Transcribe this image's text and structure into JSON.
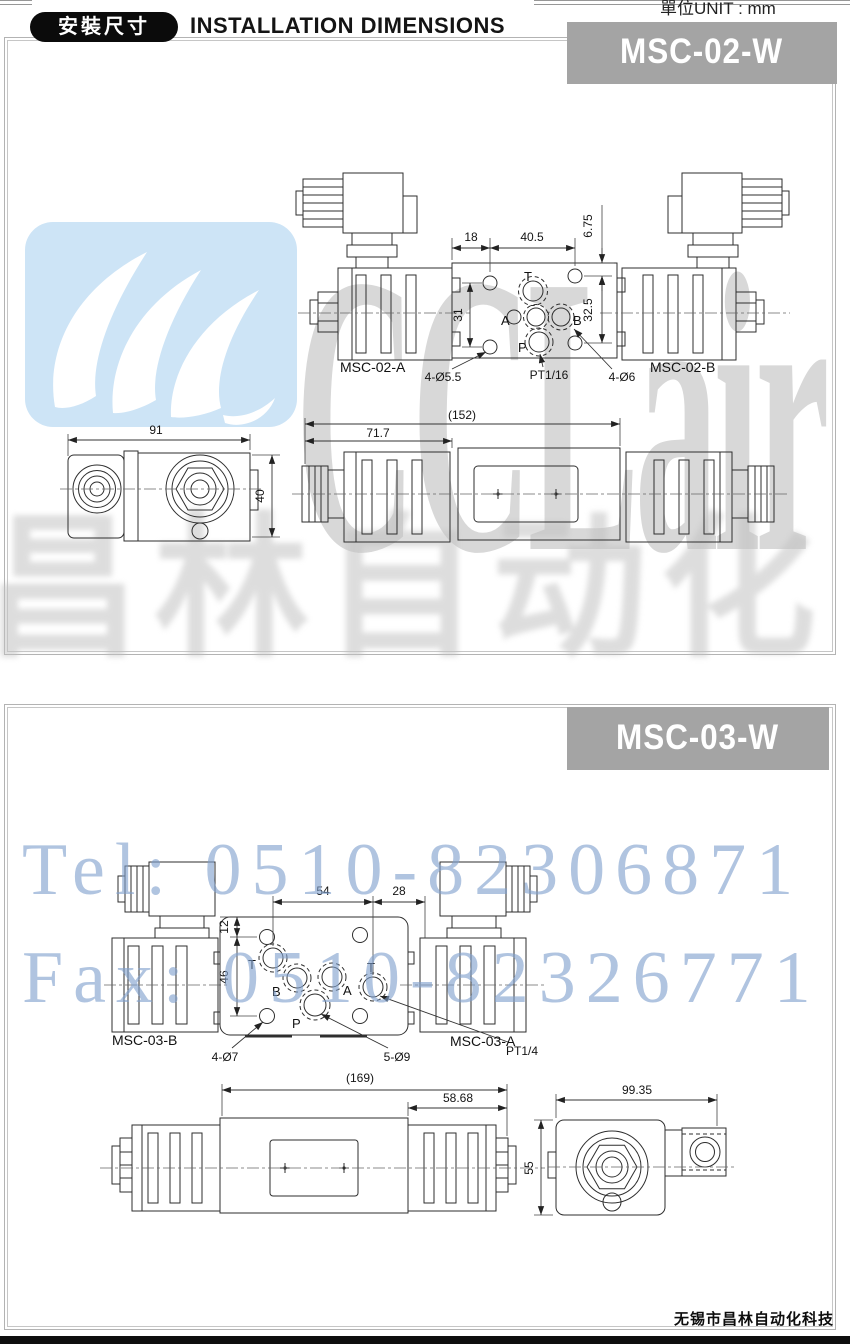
{
  "header": {
    "badge": "安裝尺寸",
    "title": "INSTALLATION DIMENSIONS",
    "unit": "單位UNIT : mm"
  },
  "panel1": {
    "model": "MSC-02-W",
    "label_a": "MSC-02-A",
    "label_b": "MSC-02-B",
    "port_t": "T",
    "port_a": "A",
    "port_b": "B",
    "port_p": "P",
    "dim_18": "18",
    "dim_40_5": "40.5",
    "dim_6_75": "6.75",
    "dim_31": "31",
    "dim_32_5": "32.5",
    "holes_small": "4-Ø5.5",
    "thread": "PT1/16",
    "holes_large": "4-Ø6",
    "dim_total": "(152)",
    "dim_partial": "71.7",
    "dim_width": "91",
    "dim_height": "40"
  },
  "panel2": {
    "model": "MSC-03-W",
    "label_b": "MSC-03-B",
    "label_a": "MSC-03-A",
    "port_t": "T",
    "port_b": "B",
    "port_a": "A",
    "port_p": "P",
    "dim_54": "54",
    "dim_28": "28",
    "dim_12": "12",
    "dim_46": "46",
    "holes_small": "4-Ø7",
    "holes_large": "5-Ø9",
    "thread": "PT1/4",
    "dim_total": "(169)",
    "dim_partial": "58.68",
    "dim_width": "99.35",
    "dim_height": "55"
  },
  "watermark": {
    "logo_text": "CCLair",
    "cn_text": "昌林自动化",
    "tel": "Tel: 0510-82306871",
    "fax": "Fax: 0510-82326771",
    "logo_bg": "#cde4f6",
    "banner_gray": "#a4a4a4",
    "blue_text": "#809fcd"
  },
  "footer": {
    "company": "无锡市昌林自动化科技"
  }
}
